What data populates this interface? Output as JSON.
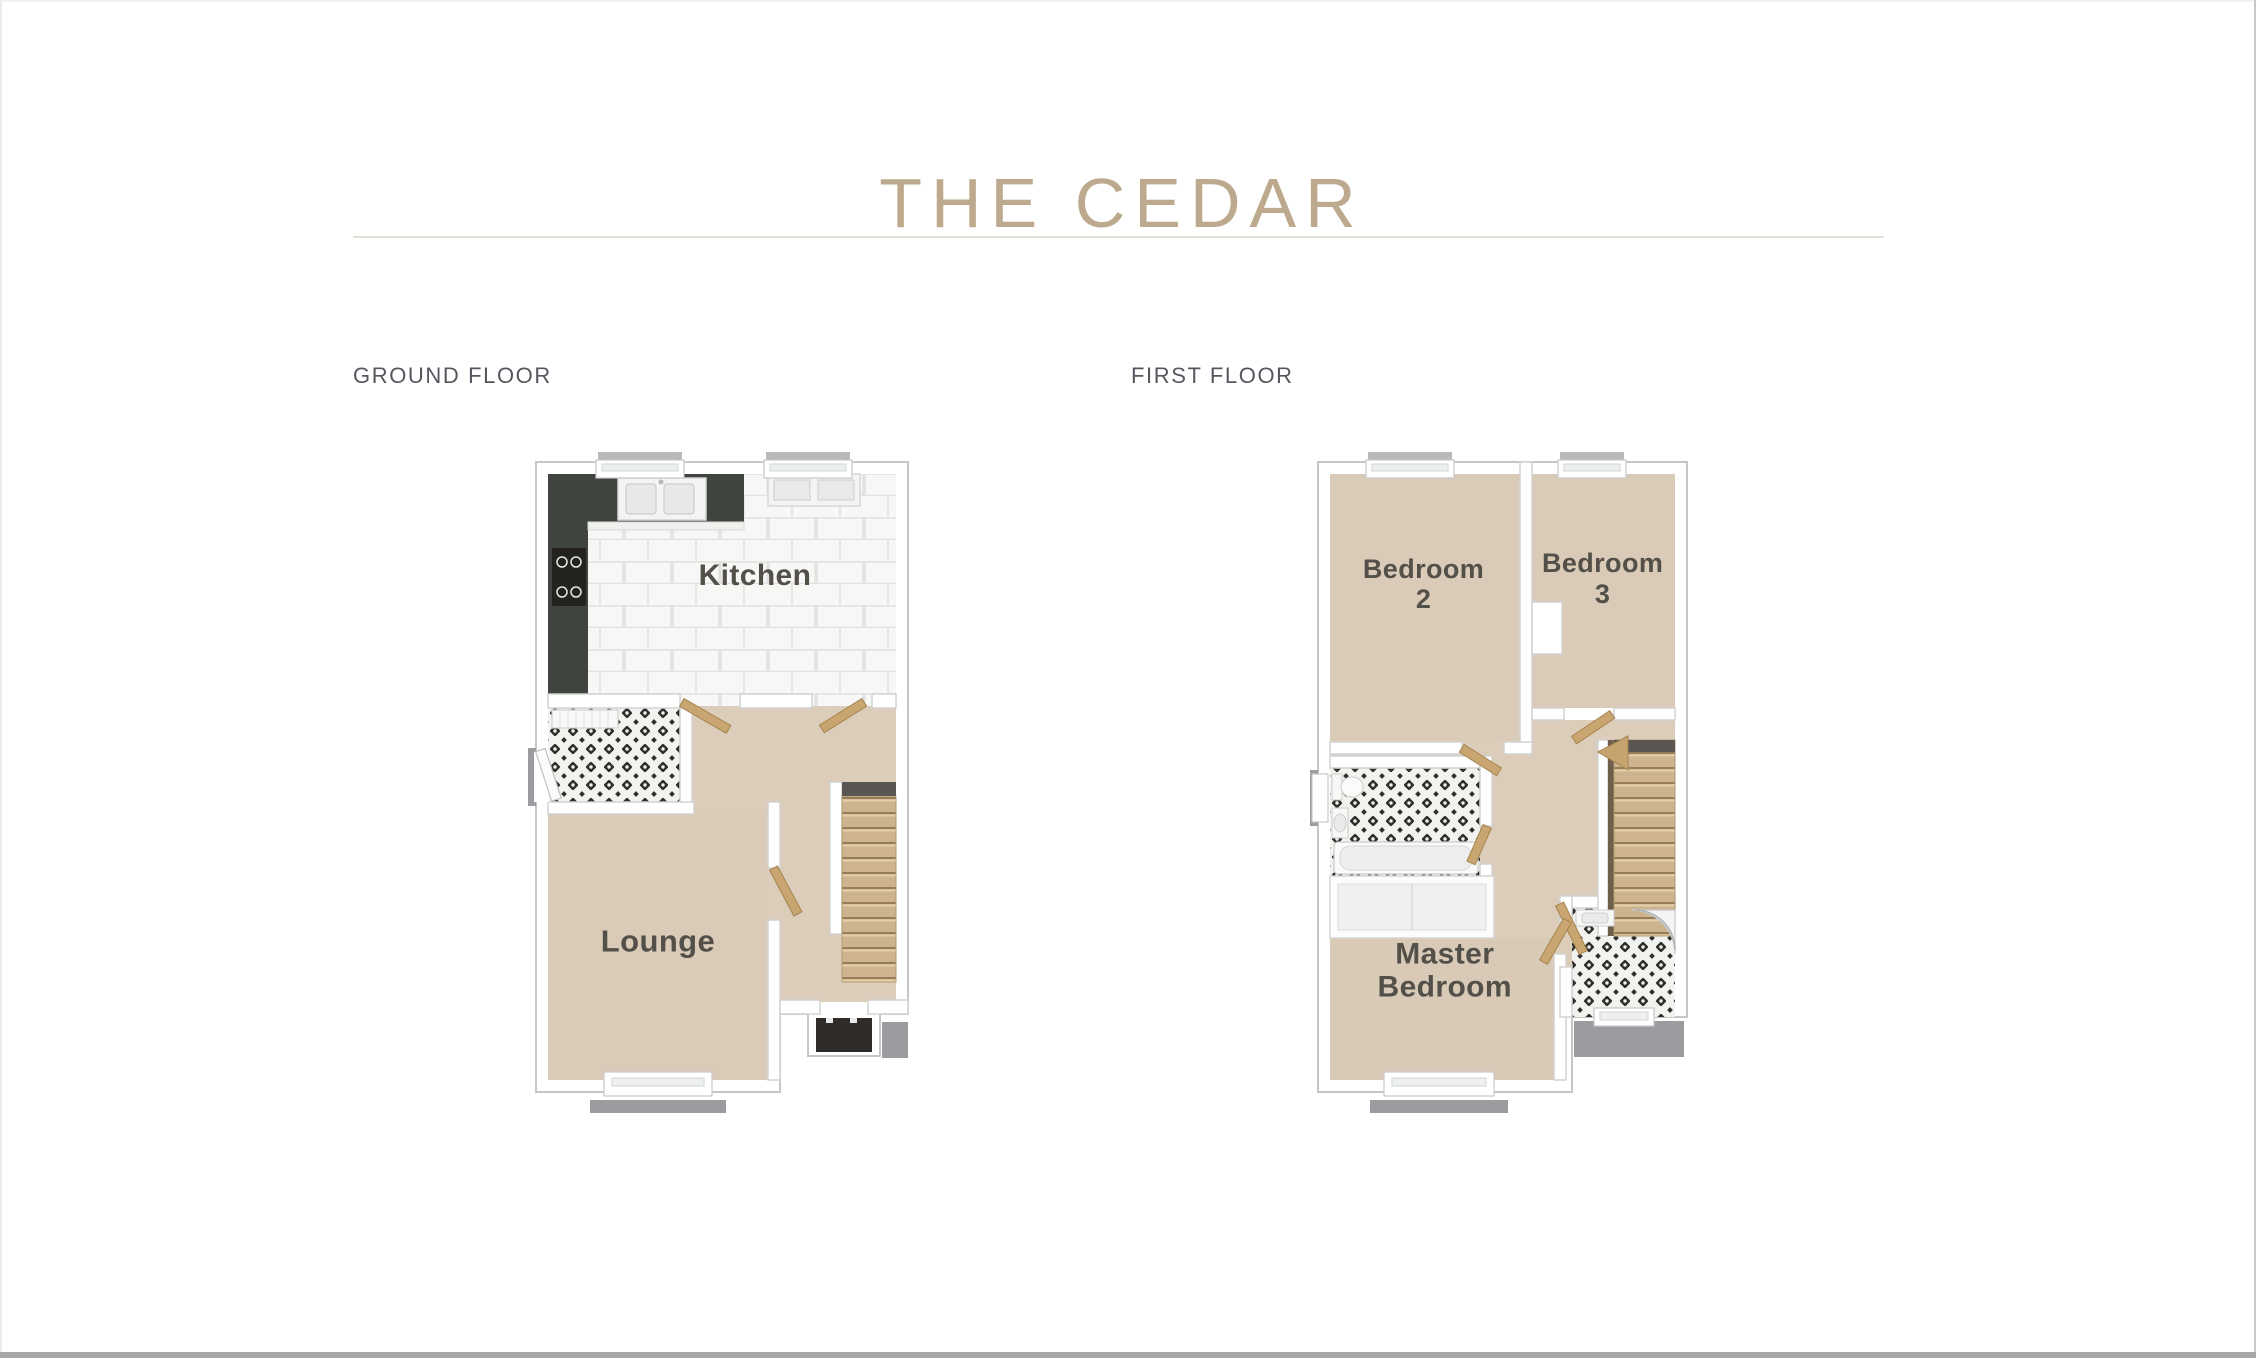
{
  "title": {
    "text": "THE CEDAR"
  },
  "floors": {
    "ground": {
      "label": "GROUND FLOOR",
      "rooms": {
        "kitchen": "Kitchen",
        "lounge": "Lounge"
      }
    },
    "first": {
      "label": "FIRST FLOOR",
      "rooms": {
        "bedroom2": {
          "line1": "Bedroom",
          "line2": "2"
        },
        "bedroom3": {
          "line1": "Bedroom",
          "line2": "3"
        },
        "master": {
          "line1": "Master",
          "line2": "Bedroom"
        }
      }
    }
  },
  "colors": {
    "title": "#bdaa8e",
    "divider": "#e3ded6",
    "floor_label": "#54585e",
    "room_label": "#534f49",
    "carpet": "#d9cbb8",
    "kitchen_tile": "#f7f7f6",
    "tile_grout": "#e1e1df",
    "counter_dark": "#3f443e",
    "mosaic_ink": "#2e2e2c",
    "stair_wood": "#cdb48e",
    "door_wood": "#c9a671",
    "exterior_step_gray": "#9c9ca0",
    "front_door_mat": "#2f2c29",
    "window_cap_gray": "#b7babc",
    "bottom_bar": "#a7a7aa"
  }
}
